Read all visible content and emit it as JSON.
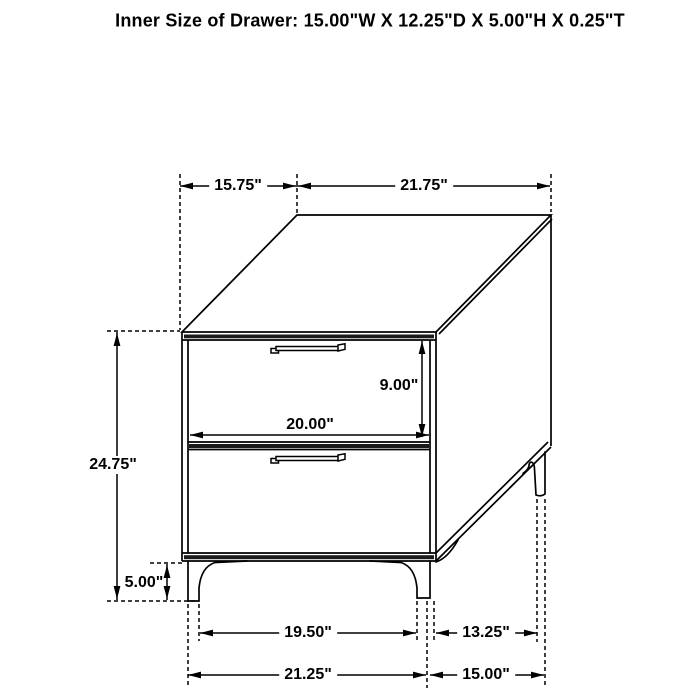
{
  "title": "Inner Size of Drawer: 15.00\"W X 12.25\"D X 5.00\"H X 0.25\"T",
  "dims": {
    "top_depth": "15.75\"",
    "top_width": "21.75\"",
    "overall_height": "24.75\"",
    "drawer_front_height": "9.00\"",
    "drawer_front_width": "20.00\"",
    "leg_height": "5.00\"",
    "front_leg_spacing": "19.50\"",
    "side_leg_spacing": "13.25\"",
    "base_front_width": "21.25\"",
    "base_side_depth": "15.00\""
  },
  "colors": {
    "line": "#000000",
    "background": "#ffffff"
  }
}
